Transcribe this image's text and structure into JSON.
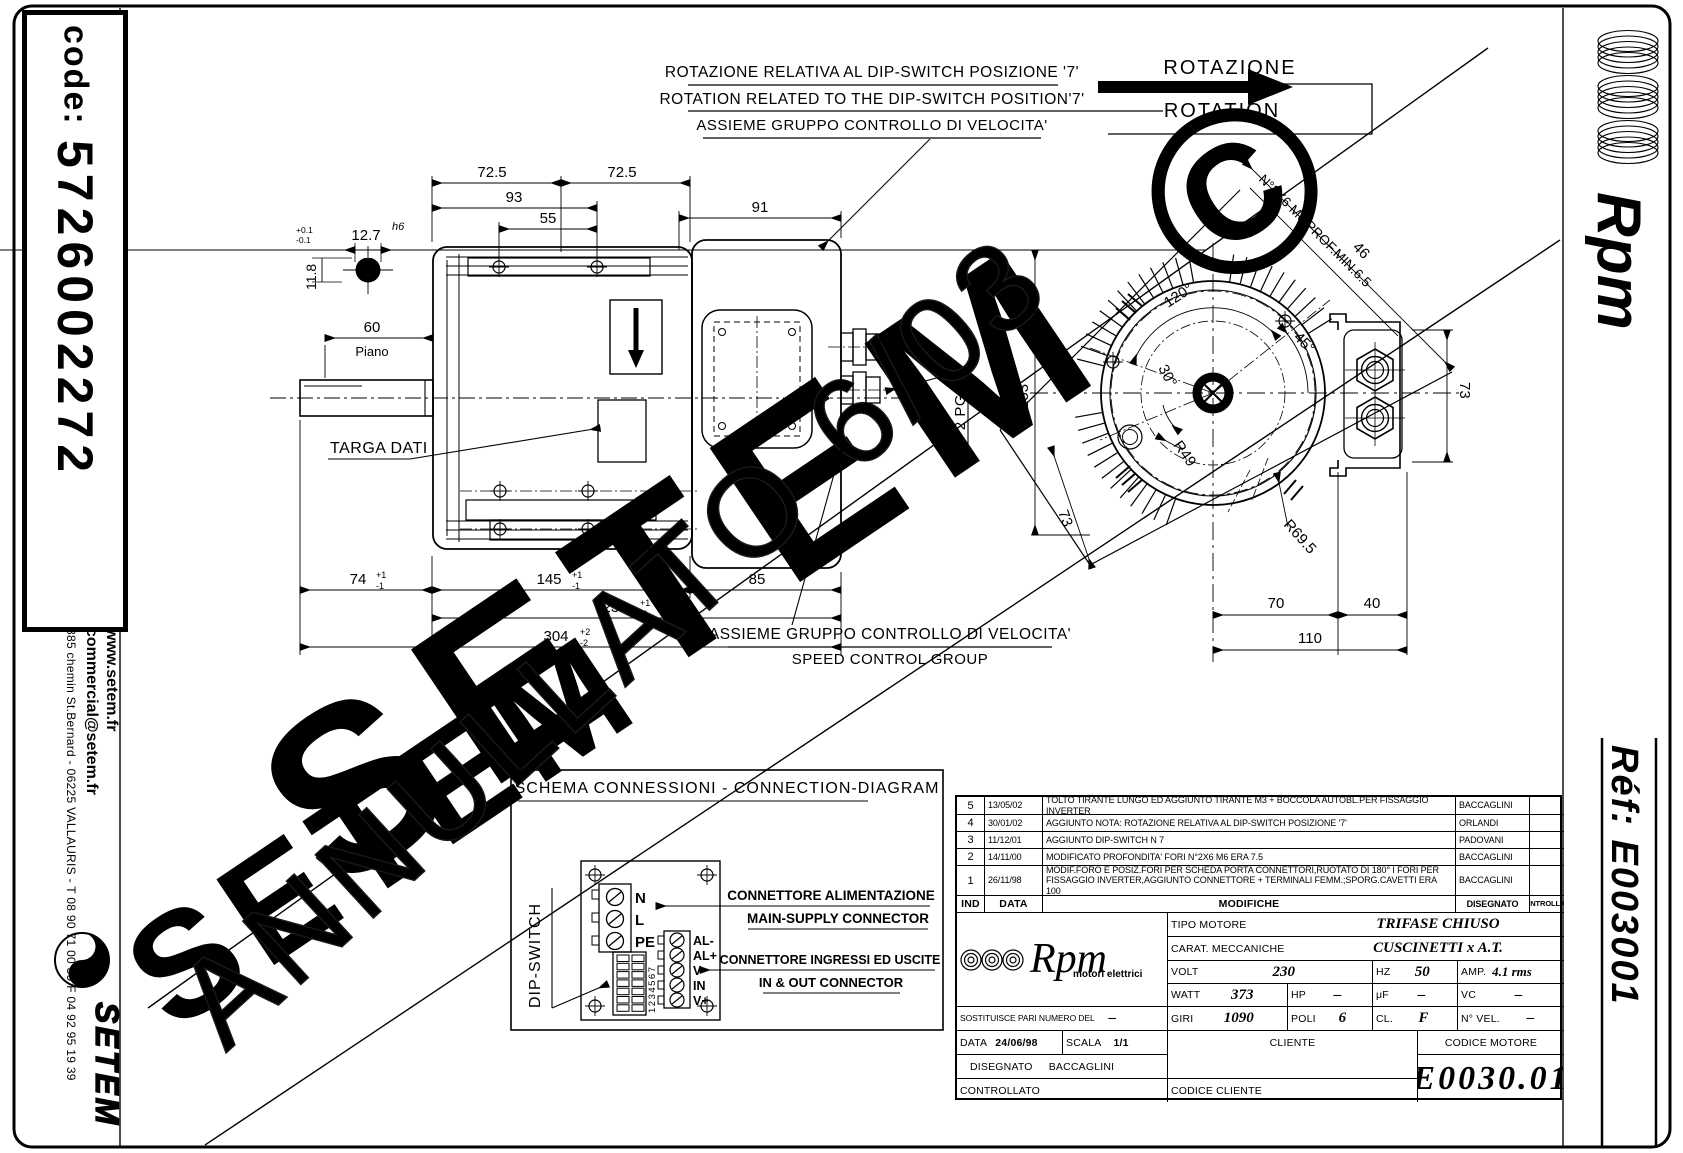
{
  "document": {
    "code_label": "code:",
    "code_value": "5726002272",
    "address": "885 chemin St.Bernard  -  06225 VALLAURIS  -  T 08 90 71 00 39   F 04 92 95 19 39",
    "website": "www.setem.fr",
    "email": "commercial@setem.fr",
    "brand": "SETEM",
    "brand_right": "Rpm",
    "ref_label": "Réf:  E003001"
  },
  "notes": {
    "rotation_it": "ROTAZIONE RELATIVA AL DIP-SWITCH POSIZIONE '7'",
    "rotation_en": "ROTATION RELATED TO THE DIP-SWITCH POSITION'7'",
    "group_top": "ASSIEME GRUPPO CONTROLLO DI VELOCITA'",
    "rotazione": "ROTAZIONE",
    "rotation": "ROTATION",
    "targa_dati": "TARGA DATI",
    "group_bottom_it": "ASSIEME GRUPPO CONTROLLO DI VELOCITA'",
    "group_bottom_en": "SPEED CONTROL GROUP"
  },
  "dims": {
    "d725a": "72.5",
    "d725b": "72.5",
    "d93": "93",
    "d55": "55",
    "d91": "91",
    "d60": "60",
    "piano": "Piano",
    "d127": "12.7",
    "h6": "h6",
    "d118": "11.8",
    "tp01": "+0.1",
    "tm01": "-0.1",
    "d74": "74",
    "d145": "145",
    "d85": "85",
    "d230": "230",
    "d304": "304",
    "tp1": "+1",
    "tm1": "-1",
    "tp2": "+2",
    "tm2": "-2",
    "d153": "⌀153",
    "a120": "120°",
    "a45": "45°",
    "a30": "30°",
    "r49": "R49",
    "r695": "R69.5",
    "d73a": "73",
    "d73b": "73",
    "d70": "70",
    "d40": "40",
    "d110": "110",
    "d46": "46",
    "holes_note": "N°2X6 M6 PROF.MIN.6.5",
    "pg9": "N°2 PG9"
  },
  "connection": {
    "title": "SCHEMA CONNESSIONI - CONNECTION-DIAGRAM",
    "dip_switch": "DIP-SWITCH",
    "dip_numbers": "1234567",
    "t_n": "N",
    "t_l": "L",
    "t_pe": "PE",
    "t_alm": "AL-",
    "t_alp": "AL+",
    "t_vm": "V-",
    "t_in": "IN",
    "t_vp": "V+",
    "main_it": "CONNETTORE ALIMENTAZIONE",
    "main_en": "MAIN-SUPPLY CONNECTOR",
    "io_it": "CONNETTORE INGRESSI ED USCITE",
    "io_en": "IN & OUT CONNECTOR"
  },
  "revisions": {
    "h_ind": "IND",
    "h_data": "DATA",
    "h_mod": "MODIFICHE",
    "h_dis": "DISEGNATO",
    "h_ctrl": "CONTROLLATO",
    "rows": [
      {
        "ind": "5",
        "date": "13/05/02",
        "text": "TOLTO TIRANTE LUNGO ED AGGIUNTO TIRANTE M3 + BOCCOLA AUTOBL.PER FISSAGGIO INVERTER",
        "by": "BACCAGLINI"
      },
      {
        "ind": "4",
        "date": "30/01/02",
        "text": "AGGIUNTO NOTA: ROTAZIONE RELATIVA AL DIP-SWITCH POSIZIONE '7'",
        "by": "ORLANDI"
      },
      {
        "ind": "3",
        "date": "11/12/01",
        "text": "AGGIUNTO DIP-SWITCH N 7",
        "by": "PADOVANI"
      },
      {
        "ind": "2",
        "date": "14/11/00",
        "text": "MODIFICATO PROFONDITA' FORI N°2X6 M6 ERA 7.5",
        "by": "BACCAGLINI"
      },
      {
        "ind": "1",
        "date": "26/11/98",
        "text": "MODIF.FORO E POSIZ.FORI PER SCHEDA PORTA CONNETTORI,RUOTATO DI 180° I FORI PER FISSAGGIO INVERTER,AGGIUNTO CONNETTORE + TERMINALI FEMM.;SPORG.CAVETTI ERA 100",
        "by": "BACCAGLINI"
      }
    ]
  },
  "titleblock": {
    "brand": "Rpm",
    "brand_sub": "motori elettrici",
    "tipo_label": "TIPO MOTORE",
    "tipo": "TRIFASE CHIUSO",
    "carat_label": "CARAT. MECCANICHE",
    "carat": "CUSCINETTI x A.T.",
    "volt_label": "VOLT",
    "volt": "230",
    "hz_label": "HZ",
    "hz": "50",
    "amp_label": "AMP.",
    "amp": "4.1 rms",
    "watt_label": "WATT",
    "watt": "373",
    "hp_label": "HP",
    "hp": "–",
    "uf_label": "μF",
    "uf": "–",
    "vc_label": "VC",
    "vc": "–",
    "sost_label": "SOSTITUISCE PARI NUMERO DEL",
    "sost": "–",
    "giri_label": "GIRI",
    "giri": "1090",
    "poli_label": "POLI",
    "poli": "6",
    "cl_label": "CL.",
    "cl": "F",
    "nvel_label": "N° VEL.",
    "nvel": "–",
    "data_label": "DATA",
    "data": "24/06/98",
    "scala_label": "SCALA",
    "scala": "1/1",
    "cliente_label": "CLIENTE",
    "codice_motore_label": "CODICE MOTORE",
    "disegnato_label": "DISEGNATO",
    "disegnato": "BACCAGLINI",
    "controllato_label": "CONTROLLATO",
    "codice_cliente_label": "CODICE CLIENTE",
    "codice_motore": "E0030.01"
  },
  "watermarks": {
    "annullato": "ANNULLATO 6/03",
    "setem_big": "SETEM ©",
    "setem_small": "SETEM"
  }
}
